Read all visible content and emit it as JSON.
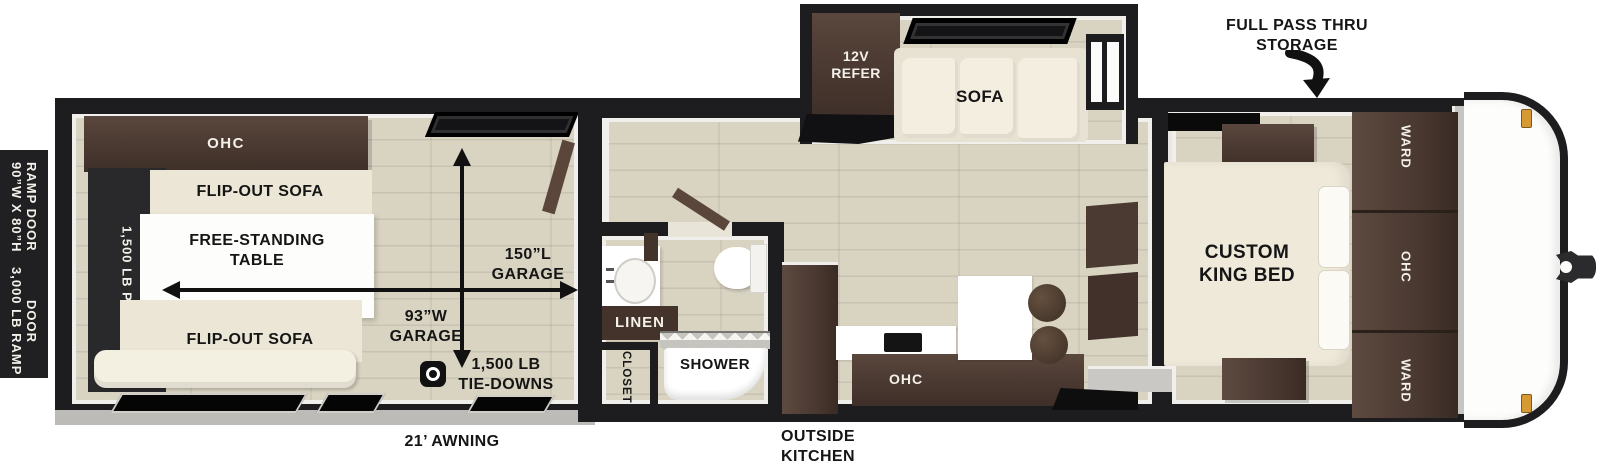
{
  "exterior": {
    "ramp_door_dimensions": "90”W X 80”H\nRAMP DOOR",
    "ramp_door_capacity": "3,000 LB RAMP\nDOOR",
    "full_pass_thru_storage": "FULL PASS THRU\nSTORAGE",
    "awning": "21’ AWNING",
    "outside_kitchen": "OUTSIDE\nKITCHEN"
  },
  "garage": {
    "ohc": "OHC",
    "flip_out_sofa_top": "FLIP-OUT SOFA",
    "flip_out_sofa_bottom": "FLIP-OUT SOFA",
    "free_standing_table": "FREE-STANDING\nTABLE",
    "patio_rating": "1,500 LB PATIO",
    "garage_length": "150”L\nGARAGE",
    "garage_width": "93”W\nGARAGE",
    "tie_downs": "1,500 LB\nTIE-DOWNS"
  },
  "living": {
    "refrigerator": "12V\nREFER",
    "sofa": "SOFA"
  },
  "bathroom": {
    "linen": "LINEN",
    "shower": "SHOWER",
    "closet": "CLOSET"
  },
  "kitchen": {
    "ohc": "OHC"
  },
  "bedroom": {
    "bed": "CUSTOM\nKING BED",
    "ward_top": "WARD",
    "ohc": "OHC",
    "ward_bottom": "WARD"
  },
  "colors": {
    "wall_black": "#1d1d1f",
    "cabinet_brown": "#4a3931",
    "floor_tan": "#d9d3c1",
    "upholstery_cream": "#ebe6d6",
    "patio_black": "#29292b",
    "marker_amber": "#d79a33"
  }
}
